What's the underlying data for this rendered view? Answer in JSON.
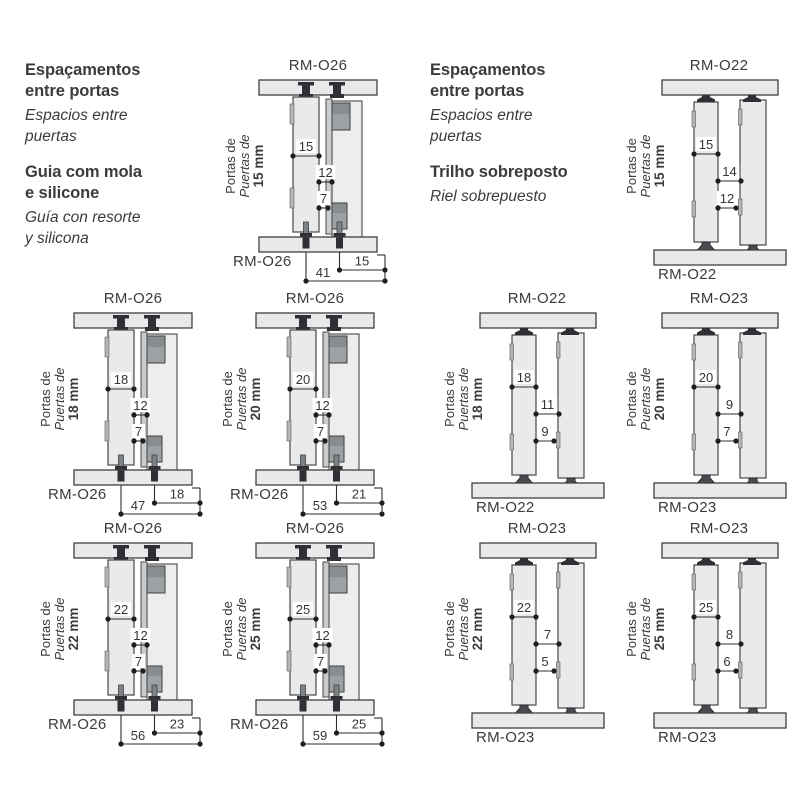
{
  "colors": {
    "ink": "#3a3b3d",
    "line": "#2e2f31",
    "panel": "#e8e9ea",
    "hardware": "#9ea1a3",
    "hardware_dark": "#2f3033",
    "dot": "#1d1e20",
    "background": "#ffffff"
  },
  "door_label": {
    "line1": "Portas de",
    "line2": "Puertas de"
  },
  "text_blocks": [
    {
      "id": "left",
      "lines": [
        {
          "t": "Espaçamentos",
          "s": "bold"
        },
        {
          "t": "entre portas",
          "s": "bold"
        },
        {
          "t": "Espacios entre",
          "s": "italic"
        },
        {
          "t": "puertas",
          "s": "italic"
        },
        {
          "t": "",
          "s": "gap"
        },
        {
          "t": "Guia com mola",
          "s": "bold"
        },
        {
          "t": "e silicone",
          "s": "bold"
        },
        {
          "t": "Guía con resorte",
          "s": "italic"
        },
        {
          "t": "y silicona",
          "s": "italic"
        }
      ]
    },
    {
      "id": "right",
      "lines": [
        {
          "t": "Espaçamentos",
          "s": "bold"
        },
        {
          "t": "entre portas",
          "s": "bold"
        },
        {
          "t": "Espacios entre",
          "s": "italic"
        },
        {
          "t": "puertas",
          "s": "italic"
        },
        {
          "t": "",
          "s": "gap"
        },
        {
          "t": "Trilho sobreposto",
          "s": "bold"
        },
        {
          "t": "Riel sobrepuesto",
          "s": "italic"
        }
      ]
    }
  ],
  "diagrams": [
    {
      "model": "RM-O26",
      "type": "spring",
      "thickness": "15 mm",
      "dims": [
        15,
        12,
        7
      ],
      "bottom_dims": [
        41,
        15
      ]
    },
    {
      "model": "RM-O22",
      "type": "surface",
      "thickness": "15 mm",
      "dims": [
        15,
        14,
        12
      ]
    },
    {
      "model": "RM-O26",
      "type": "spring",
      "thickness": "18 mm",
      "dims": [
        18,
        12,
        7
      ],
      "bottom_dims": [
        47,
        18
      ]
    },
    {
      "model": "RM-O26",
      "type": "spring",
      "thickness": "20 mm",
      "dims": [
        20,
        12,
        7
      ],
      "bottom_dims": [
        53,
        21
      ]
    },
    {
      "model": "RM-O22",
      "type": "surface",
      "thickness": "18 mm",
      "dims": [
        18,
        11,
        9
      ]
    },
    {
      "model": "RM-O23",
      "type": "surface",
      "thickness": "20 mm",
      "dims": [
        20,
        9,
        7
      ]
    },
    {
      "model": "RM-O26",
      "type": "spring",
      "thickness": "22 mm",
      "dims": [
        22,
        12,
        7
      ],
      "bottom_dims": [
        56,
        23
      ]
    },
    {
      "model": "RM-O26",
      "type": "spring",
      "thickness": "25 mm",
      "dims": [
        25,
        12,
        7
      ],
      "bottom_dims": [
        59,
        25
      ]
    },
    {
      "model": "RM-O23",
      "type": "surface",
      "thickness": "22 mm",
      "dims": [
        22,
        7,
        5
      ]
    },
    {
      "model": "RM-O23",
      "type": "surface",
      "thickness": "25 mm",
      "dims": [
        25,
        8,
        6
      ]
    }
  ]
}
